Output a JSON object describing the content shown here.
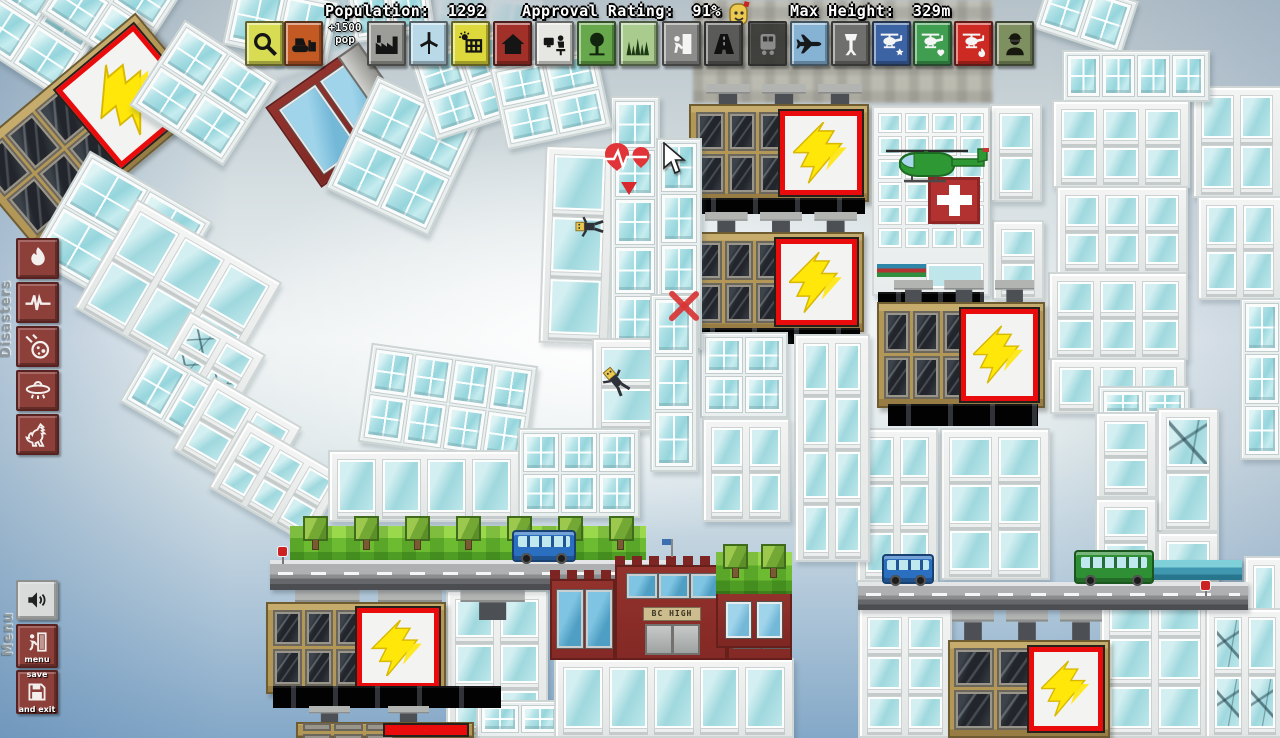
{
  "hud": {
    "population_label": "Population:",
    "population_value": "1292",
    "approval_label": "Approval Rating:",
    "approval_value": "91%",
    "max_height_label": "Max Height:",
    "max_height_value": "329m",
    "pop_bonus_line1": "+1500",
    "pop_bonus_line2": "pop",
    "toolbar": [
      {
        "name": "magnifier",
        "x": 245,
        "bg": "#d8dc52",
        "fg": "#151515"
      },
      {
        "name": "bulldozer",
        "x": 284,
        "bg": "#c35a24",
        "fg": "#151515"
      },
      {
        "name": "factory",
        "x": 367,
        "bg": "#9c9c98",
        "fg": "#151515"
      },
      {
        "name": "wind-turbine",
        "x": 409,
        "bg": "#b9d9e8",
        "fg": "#151515"
      },
      {
        "name": "solar-panel",
        "x": 451,
        "bg": "#ddd83b",
        "fg": "#151515"
      },
      {
        "name": "house",
        "x": 493,
        "bg": "#a03028",
        "fg": "#151515"
      },
      {
        "name": "office",
        "x": 535,
        "bg": "#e6e6e2",
        "fg": "#151515"
      },
      {
        "name": "tree",
        "x": 577,
        "bg": "#68a84c",
        "fg": "#12250f"
      },
      {
        "name": "grass",
        "x": 619,
        "bg": "#aacb8e",
        "fg": "#1d3a14"
      },
      {
        "name": "tenant",
        "x": 662,
        "bg": "#8c8c8a",
        "fg": "#f5f5f5"
      },
      {
        "name": "road",
        "x": 704,
        "bg": "#5a5a58",
        "fg": "#111111"
      },
      {
        "name": "train",
        "x": 748,
        "bg": "#30302e",
        "fg": "#888888",
        "faded": true
      },
      {
        "name": "airplane",
        "x": 790,
        "bg": "#86b3d4",
        "fg": "#16181c"
      },
      {
        "name": "airport-tower",
        "x": 831,
        "bg": "#6f6f6d",
        "fg": "#f5f5f5"
      },
      {
        "name": "police-helicopter",
        "x": 872,
        "bg": "#3c64a4",
        "fg": "#f5f5f5"
      },
      {
        "name": "medic-helicopter",
        "x": 913,
        "bg": "#3f9e50",
        "fg": "#f5f5f5"
      },
      {
        "name": "fire-helicopter",
        "x": 954,
        "bg": "#cc2a22",
        "fg": "#f5f5f5"
      },
      {
        "name": "soldier",
        "x": 995,
        "bg": "#7e8f60",
        "fg": "#17190f"
      }
    ],
    "disasters": {
      "label": "Disasters",
      "items": [
        {
          "name": "fire"
        },
        {
          "name": "earthquake"
        },
        {
          "name": "meteor"
        },
        {
          "name": "ufo"
        },
        {
          "name": "godzilla"
        }
      ]
    },
    "menu": {
      "label": "Menu",
      "buttons": [
        {
          "name": "sound",
          "icon": "speaker",
          "style": "light",
          "y": 580,
          "h": 40
        },
        {
          "name": "menu",
          "icon": "exit-door",
          "label": "menu",
          "y": 624,
          "h": 44
        },
        {
          "name": "save-exit",
          "icon": "save-disk",
          "label_top": "save",
          "label_bottom": "and exit",
          "y": 670,
          "h": 44
        }
      ]
    }
  },
  "palette": {
    "sign_border_red": "#ea0c0c",
    "bolt_yellow": "#ffe70a",
    "glass_aqua": "#9fd8de",
    "office_tan": "#b29757",
    "disaster_red": "#8d3f3a",
    "grass_green": "#6cbb30"
  },
  "scene": {
    "school_sign": "BC HIGH",
    "blocks": [
      {
        "t": "bgb",
        "x": 693,
        "y": 0,
        "w": 300,
        "h": 103
      },
      {
        "t": "g",
        "x": 255,
        "y": -8,
        "w": 130,
        "h": 72,
        "r": -18,
        "c": 2,
        "o": 1,
        "fade": true
      },
      {
        "t": "g",
        "x": 430,
        "y": -10,
        "w": 110,
        "h": 60,
        "r": 10,
        "c": 2,
        "o": 1,
        "fade": true
      },
      {
        "t": "w",
        "x": 1192,
        "y": 86,
        "w": 90,
        "h": 112,
        "c": 2,
        "o": 2
      },
      {
        "t": "w",
        "x": 1197,
        "y": 196,
        "w": 86,
        "h": 104,
        "c": 2,
        "o": 2
      },
      {
        "t": "g",
        "x": 1240,
        "y": 298,
        "w": 44,
        "h": 162,
        "c": 1,
        "o": 3
      },
      {
        "t": "w",
        "x": 1244,
        "y": 556,
        "w": 40,
        "h": 182,
        "c": 1,
        "o": 3
      },
      {
        "t": "g",
        "x": 1040,
        "y": -14,
        "w": 92,
        "h": 58,
        "r": 18,
        "c": 2,
        "o": 1
      },
      {
        "t": "g",
        "x": 1062,
        "y": 50,
        "w": 148,
        "h": 52,
        "c": 4,
        "o": 1
      },
      {
        "t": "w",
        "x": 1052,
        "y": 100,
        "w": 138,
        "h": 88,
        "c": 3,
        "o": 2
      },
      {
        "t": "w",
        "x": 1056,
        "y": 186,
        "w": 132,
        "h": 88,
        "c": 3,
        "o": 2
      },
      {
        "t": "w",
        "x": 1048,
        "y": 272,
        "w": 140,
        "h": 88,
        "c": 3,
        "o": 2
      },
      {
        "t": "w",
        "x": 1050,
        "y": 358,
        "w": 136,
        "h": 56,
        "c": 3,
        "o": 1
      },
      {
        "t": "g",
        "x": 1098,
        "y": 386,
        "w": 92,
        "h": 34,
        "c": 2,
        "o": 1
      },
      {
        "t": "w",
        "x": 1095,
        "y": 412,
        "w": 62,
        "h": 86,
        "c": 1,
        "o": 2
      },
      {
        "t": "w",
        "x": 1157,
        "y": 408,
        "w": 62,
        "h": 124,
        "c": 1,
        "o": 2,
        "k": true
      },
      {
        "t": "w",
        "x": 1095,
        "y": 498,
        "w": 62,
        "h": 84,
        "c": 1,
        "o": 2
      },
      {
        "t": "w",
        "x": 1157,
        "y": 532,
        "w": 62,
        "h": 50,
        "c": 1,
        "o": 1
      },
      {
        "t": "st",
        "x": 1148,
        "y": 560,
        "w": 94,
        "h": 20
      },
      {
        "t": "w",
        "x": 1100,
        "y": 580,
        "w": 110,
        "h": 158,
        "c": 2,
        "o": 3
      },
      {
        "t": "w",
        "x": 1205,
        "y": 608,
        "w": 80,
        "h": 130,
        "c": 2,
        "o": 2,
        "k": true
      },
      {
        "t": "f",
        "x": 700,
        "y": 84,
        "w": 168,
        "h": 24,
        "n": 3
      },
      {
        "t": "o",
        "x": 689,
        "y": 104,
        "w": 180,
        "h": 98,
        "c": 3,
        "s": true
      },
      {
        "t": "d",
        "x": 693,
        "y": 198,
        "w": 172,
        "h": 16
      },
      {
        "t": "f",
        "x": 699,
        "y": 212,
        "w": 164,
        "h": 22,
        "n": 3
      },
      {
        "t": "o",
        "x": 687,
        "y": 232,
        "w": 177,
        "h": 100,
        "c": 3,
        "s": true
      },
      {
        "t": "d",
        "x": 692,
        "y": 328,
        "w": 168,
        "h": 16
      },
      {
        "t": "w",
        "x": 990,
        "y": 104,
        "w": 52,
        "h": 98,
        "c": 1,
        "o": 2
      },
      {
        "t": "w",
        "x": 992,
        "y": 220,
        "w": 52,
        "h": 80,
        "c": 1,
        "o": 2
      },
      {
        "t": "h",
        "x": 872,
        "y": 106,
        "w": 118,
        "h": 190
      },
      {
        "t": "d",
        "x": 878,
        "y": 292,
        "w": 106,
        "h": 12
      },
      {
        "t": "f",
        "x": 888,
        "y": 280,
        "w": 152,
        "h": 24,
        "n": 3
      },
      {
        "t": "o",
        "x": 877,
        "y": 302,
        "w": 168,
        "h": 106,
        "c": 3,
        "s": true
      },
      {
        "t": "d",
        "x": 888,
        "y": 404,
        "w": 150,
        "h": 22
      },
      {
        "t": "w",
        "x": 940,
        "y": 428,
        "w": 110,
        "h": 152,
        "c": 2,
        "o": 3
      },
      {
        "t": "w",
        "x": 856,
        "y": 428,
        "w": 82,
        "h": 154,
        "c": 2,
        "o": 3
      },
      {
        "t": "w",
        "x": 794,
        "y": 334,
        "w": 76,
        "h": 228,
        "c": 2,
        "o": 4
      },
      {
        "t": "g",
        "x": 700,
        "y": 332,
        "w": 88,
        "h": 86,
        "c": 2,
        "o": 2
      },
      {
        "t": "w",
        "x": 702,
        "y": 418,
        "w": 88,
        "h": 104,
        "c": 2,
        "o": 2
      },
      {
        "t": "w",
        "x": 542,
        "y": 146,
        "w": 70,
        "h": 198,
        "r": 2,
        "c": 1,
        "o": 3
      },
      {
        "t": "g",
        "x": 610,
        "y": 96,
        "w": 50,
        "h": 252,
        "c": 1,
        "o": 5
      },
      {
        "t": "g",
        "x": 656,
        "y": 138,
        "w": 46,
        "h": 212,
        "c": 1,
        "o": 4
      },
      {
        "t": "g",
        "x": 228,
        "y": -10,
        "w": 106,
        "h": 66,
        "r": 12,
        "c": 2,
        "o": 1
      },
      {
        "t": "g",
        "x": 350,
        "y": -14,
        "w": 82,
        "h": 52,
        "r": -8,
        "c": 2,
        "o": 1
      },
      {
        "t": "r",
        "x": 283,
        "y": 66,
        "w": 114,
        "h": 98,
        "r": -35,
        "c": 2,
        "o": 1,
        "cap": true
      },
      {
        "t": "g",
        "x": 346,
        "y": 94,
        "w": 114,
        "h": 124,
        "r": 25,
        "c": 2,
        "o": 2
      },
      {
        "t": "g",
        "x": 420,
        "y": 40,
        "w": 98,
        "h": 88,
        "r": -18,
        "c": 2,
        "o": 2
      },
      {
        "t": "g",
        "x": 497,
        "y": 56,
        "w": 108,
        "h": 84,
        "r": -12,
        "c": 2,
        "o": 2
      },
      {
        "t": "g",
        "x": -20,
        "y": -30,
        "w": 115,
        "h": 105,
        "r": 33,
        "c": 2,
        "o": 2
      },
      {
        "t": "g",
        "x": 56,
        "y": -46,
        "w": 110,
        "h": 96,
        "r": 33,
        "c": 2,
        "o": 2
      },
      {
        "t": "o",
        "x": -28,
        "y": 72,
        "w": 228,
        "h": 118,
        "r": -40,
        "c": 3,
        "s": true
      },
      {
        "t": "g",
        "x": 148,
        "y": 42,
        "w": 112,
        "h": 102,
        "r": 33,
        "c": 2,
        "o": 2
      },
      {
        "t": "g",
        "x": 50,
        "y": 178,
        "w": 142,
        "h": 122,
        "r": 30,
        "c": 2,
        "o": 2
      },
      {
        "t": "w",
        "x": 94,
        "y": 232,
        "w": 168,
        "h": 126,
        "r": 30,
        "c": 3,
        "o": 2
      },
      {
        "t": "w",
        "x": 166,
        "y": 328,
        "w": 88,
        "h": 72,
        "r": 30,
        "c": 2,
        "o": 2,
        "k": true
      },
      {
        "t": "g",
        "x": 126,
        "y": 376,
        "w": 138,
        "h": 64,
        "r": 30,
        "c": 3,
        "o": 1
      },
      {
        "t": "w",
        "x": 186,
        "y": 396,
        "w": 102,
        "h": 84,
        "r": 30,
        "c": 2,
        "o": 2
      },
      {
        "t": "w",
        "x": 220,
        "y": 443,
        "w": 114,
        "h": 78,
        "r": 30,
        "c": 3,
        "o": 2
      },
      {
        "t": "g",
        "x": 364,
        "y": 354,
        "w": 168,
        "h": 100,
        "r": 8,
        "c": 4,
        "o": 2
      },
      {
        "t": "w",
        "x": 592,
        "y": 338,
        "w": 74,
        "h": 94,
        "c": 1,
        "o": 2
      },
      {
        "t": "g",
        "x": 650,
        "y": 294,
        "w": 48,
        "h": 178,
        "c": 1,
        "o": 3
      },
      {
        "t": "w",
        "x": 328,
        "y": 450,
        "w": 192,
        "h": 72,
        "c": 4,
        "o": 1
      },
      {
        "t": "g",
        "x": 518,
        "y": 428,
        "w": 122,
        "h": 90,
        "c": 3,
        "o": 2
      },
      {
        "t": "w",
        "x": 446,
        "y": 590,
        "w": 102,
        "h": 148,
        "c": 2,
        "o": 3
      },
      {
        "t": "g",
        "x": 476,
        "y": 700,
        "w": 88,
        "h": 38,
        "c": 2,
        "o": 1
      },
      {
        "t": "f",
        "x": 286,
        "y": 590,
        "w": 248,
        "h": 30,
        "n": 3
      },
      {
        "t": "o",
        "x": 266,
        "y": 602,
        "w": 180,
        "h": 92,
        "c": 3,
        "s": true
      },
      {
        "t": "d",
        "x": 273,
        "y": 686,
        "w": 228,
        "h": 22
      },
      {
        "t": "f",
        "x": 290,
        "y": 706,
        "w": 158,
        "h": 18,
        "n": 2
      },
      {
        "t": "o",
        "x": 296,
        "y": 722,
        "w": 178,
        "h": 16,
        "c": 3,
        "s": true
      },
      {
        "t": "gr",
        "x": 290,
        "y": 526,
        "w": 356,
        "h": 38,
        "n": 7
      },
      {
        "t": "b",
        "x": 270,
        "y": 560,
        "w": 398,
        "h": 30
      },
      {
        "t": "w",
        "x": 554,
        "y": 658,
        "w": 240,
        "h": 80,
        "c": 5,
        "o": 1
      },
      {
        "t": "s",
        "x": 550,
        "y": 556,
        "w": 242,
        "h": 104
      },
      {
        "t": "r",
        "x": 716,
        "y": 592,
        "w": 76,
        "h": 56,
        "c": 2,
        "o": 1
      },
      {
        "t": "gr",
        "x": 716,
        "y": 552,
        "w": 76,
        "h": 42,
        "n": 2
      },
      {
        "t": "w",
        "x": 858,
        "y": 608,
        "w": 94,
        "h": 130,
        "c": 2,
        "o": 3
      },
      {
        "t": "f",
        "x": 946,
        "y": 608,
        "w": 162,
        "h": 34,
        "n": 3
      },
      {
        "t": "o",
        "x": 948,
        "y": 640,
        "w": 162,
        "h": 98,
        "c": 2,
        "s": true
      },
      {
        "t": "b",
        "x": 858,
        "y": 582,
        "w": 390,
        "h": 28
      }
    ],
    "props": [
      {
        "p": "heli",
        "x": 880,
        "y": 146,
        "w": 114,
        "h": 38
      },
      {
        "p": "bus",
        "x": 512,
        "y": 530,
        "w": 64,
        "h": 32,
        "color": "#2a6fc0"
      },
      {
        "p": "bus",
        "x": 882,
        "y": 554,
        "w": 52,
        "h": 30,
        "color": "#2a6fc0"
      },
      {
        "p": "bus",
        "x": 1074,
        "y": 550,
        "w": 80,
        "h": 34,
        "color": "#2f8f35"
      },
      {
        "p": "person",
        "x": 578,
        "y": 212,
        "w": 24,
        "h": 30,
        "r": 135
      },
      {
        "p": "person",
        "x": 604,
        "y": 366,
        "w": 24,
        "h": 32,
        "r": -20
      },
      {
        "p": "health",
        "x": 602,
        "y": 140,
        "w": 54,
        "h": 62
      },
      {
        "p": "xmark",
        "x": 666,
        "y": 288,
        "w": 36,
        "h": 36
      },
      {
        "p": "sign",
        "x": 277,
        "y": 546,
        "w": 10,
        "h": 18
      },
      {
        "p": "sign",
        "x": 1200,
        "y": 580,
        "w": 10,
        "h": 16
      },
      {
        "p": "cursor",
        "x": 662,
        "y": 142,
        "w": 26,
        "h": 34
      }
    ]
  }
}
